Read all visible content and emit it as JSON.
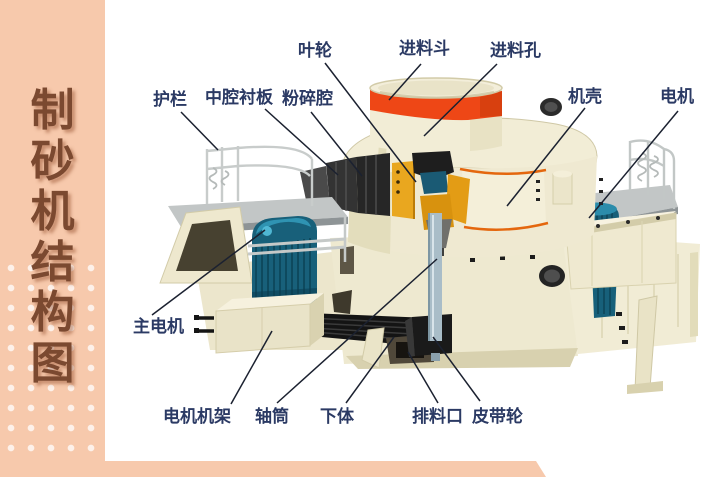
{
  "sidebar": {
    "title": "制砂机结构图",
    "bg_color": "#f7c9ac",
    "text_color": "#7b4930"
  },
  "diagram": {
    "label_color": "#2b3a64",
    "line_color": "#1b2130",
    "machine_colors": {
      "cream": "#efe9d1",
      "hopper_band_red": "#ee4716",
      "door_trim_orange": "#e4670e",
      "motor_teal": "#18607a",
      "impeller_yellow": "#e9a71f",
      "belt_black": "#141414"
    },
    "labels": [
      {
        "id": "impeller",
        "text": "叶轮",
        "x": 298,
        "y": 42,
        "line": [
          325,
          63,
          416,
          182
        ]
      },
      {
        "id": "feed-hopper",
        "text": "进料斗",
        "x": 399,
        "y": 40,
        "line": [
          421,
          64,
          389,
          100
        ]
      },
      {
        "id": "feed-hole",
        "text": "进料孔",
        "x": 490,
        "y": 42,
        "line": [
          497,
          64,
          424,
          136
        ]
      },
      {
        "id": "guardrail",
        "text": "护栏",
        "x": 153,
        "y": 91,
        "line": [
          181,
          112,
          218,
          150
        ]
      },
      {
        "id": "middle-cavity-liner",
        "text": "中腔衬板",
        "x": 205,
        "y": 89,
        "line": [
          265,
          109,
          338,
          175
        ]
      },
      {
        "id": "crushing-chamber",
        "text": "粉碎腔",
        "x": 282,
        "y": 90,
        "line": [
          311,
          112,
          362,
          176
        ]
      },
      {
        "id": "casing",
        "text": "机壳",
        "x": 568,
        "y": 88,
        "line": [
          585,
          108,
          507,
          206
        ]
      },
      {
        "id": "motor",
        "text": "电机",
        "x": 660,
        "y": 88,
        "line": [
          678,
          111,
          589,
          218
        ]
      },
      {
        "id": "main-motor",
        "text": "主电机",
        "x": 133,
        "y": 318,
        "line": [
          152,
          315,
          265,
          230
        ]
      },
      {
        "id": "motor-frame",
        "text": "电机机架",
        "x": 163,
        "y": 408,
        "line": [
          231,
          404,
          272,
          331
        ]
      },
      {
        "id": "shaft-tube",
        "text": "轴筒",
        "x": 255,
        "y": 408,
        "line": [
          277,
          403,
          437,
          259
        ]
      },
      {
        "id": "lower-body",
        "text": "下体",
        "x": 320,
        "y": 408,
        "line": [
          346,
          403,
          394,
          337
        ]
      },
      {
        "id": "discharge-port",
        "text": "排料口",
        "x": 412,
        "y": 408,
        "line": [
          438,
          403,
          408,
          352
        ]
      },
      {
        "id": "belt-pulley",
        "text": "皮带轮",
        "x": 472,
        "y": 408,
        "line": [
          480,
          401,
          433,
          337
        ]
      }
    ]
  }
}
